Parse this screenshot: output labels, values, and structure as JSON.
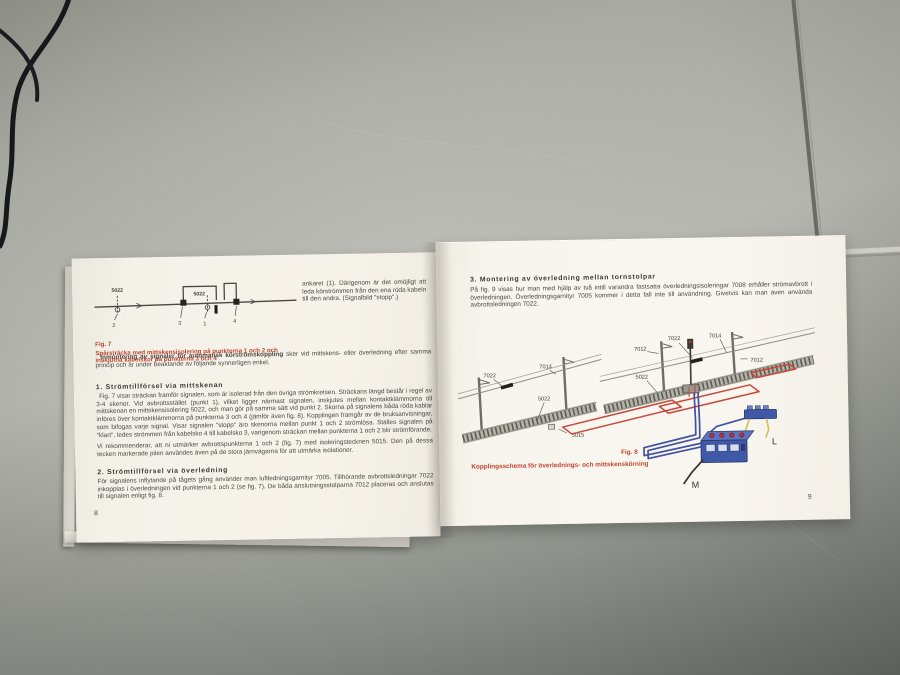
{
  "colors": {
    "caption_red": "#c0452f",
    "wire_red": "#c8493c",
    "wire_blue": "#3f51a3",
    "wire_yellow": "#d2bf58",
    "transformer_blue": "#4058a8"
  },
  "left_page": {
    "fig7": {
      "label": "Fig. 7",
      "caption": "Spårsträcka med mittskensisolering på punkterna 1 och 2 och inskjutna kabelskor på punkterna 3 och 4",
      "labels": {
        "left_insulation": "5022",
        "mid_insulation": "5022",
        "p1": "1",
        "p2": "2",
        "p3": "3",
        "p4": "4"
      }
    },
    "top_right_paragraph": "ankaret (1). Därigenom är det omöjligt att leda körströmmen från den ena röda kabeln till den andra. (Signalbild \"stopp\".)",
    "intro_bold": "Inmontering av signaler för automatisk körströmskoppling",
    "intro_rest": " sker vid mittskens- eller överledning efter samma princip och är under beaktande av följande synnerligen enkel.",
    "section1": {
      "heading": "1. Strömtillförsel via mittskenan",
      "para1": "Fig. 7 visar sträckan framför signalen, som är isolerad från den övriga strömkretsen. Sträckans längd består i regel av 3-4 skenor. Vid avbrottsstället (punkt 1), vilket ligger närmast signalen, inskjutes mellan kontaktklämmorna till mittskenan en mittskensisolering 5022, och man gör på samma sätt vid punkt 2. Skorna på signalens båda röda kablar införes över kontaktklämmorna på punkterna 3 och 4 (jämför även fig. 8). Kopplingen framgår av de bruksanvisningar, som bifogas varje signal. Visar signalen \"stopp\" äro skenorna mellan punkt 1 och 2 strömlösa. Ställes signalen på \"klart\", ledes strömmen från kabelsko 4 till kabelsko 3, varigenom sträckan mellan punkterna 1 och 2 blir strömförande.",
      "para2": "Vi rekommenderar, att ni utmärker avbrottspunkterna 1 och 2 (fig. 7) med isoleringstecknen 5015. Den på dessa tecken markerade pilen användes även på de stora järnvägarna för att utmärka isolationer."
    },
    "section2": {
      "heading": "2. Strömtillförsel via överledning",
      "para": "För signalens inflytande på tågets gång använder man luftledningsgarnityr 7005. Tillhörande avbrottsledningar 7022 inkopplas i överledningen vid punkterna 1 och 2 (se fig. 7). De båda anslutningsstolparna 7012 placeras och anslutas till signalen enligt fig. 8."
    },
    "page_number": "8"
  },
  "right_page": {
    "section3": {
      "heading": "3. Montering av överledning mellan tornstolpar",
      "para": "På fig. 9 visas hur man med hjälp av två intill varandra fastsatta överledningsisoleringar 7008 erhåller strömavbrott i överledningen. Överledningsgarnityr 7005 kommer i detta fall inte till användning. Givetvis kan man även använda avbrottsledningen 7022."
    },
    "fig8": {
      "label": "Fig. 8",
      "caption": "Kopplingsschema för överlednings- och mittskenskörning",
      "labels": {
        "left_wire_break": "7022",
        "left_wire": "7014",
        "left_track": "5022",
        "left_sign": "5015",
        "right_mast_left": "7012",
        "right_wire_break": "7022",
        "right_wire": "7014",
        "right_mast_right": "7012",
        "right_track": "5022",
        "terminal_l": "L",
        "terminal_m": "M"
      }
    },
    "page_number": "9"
  }
}
